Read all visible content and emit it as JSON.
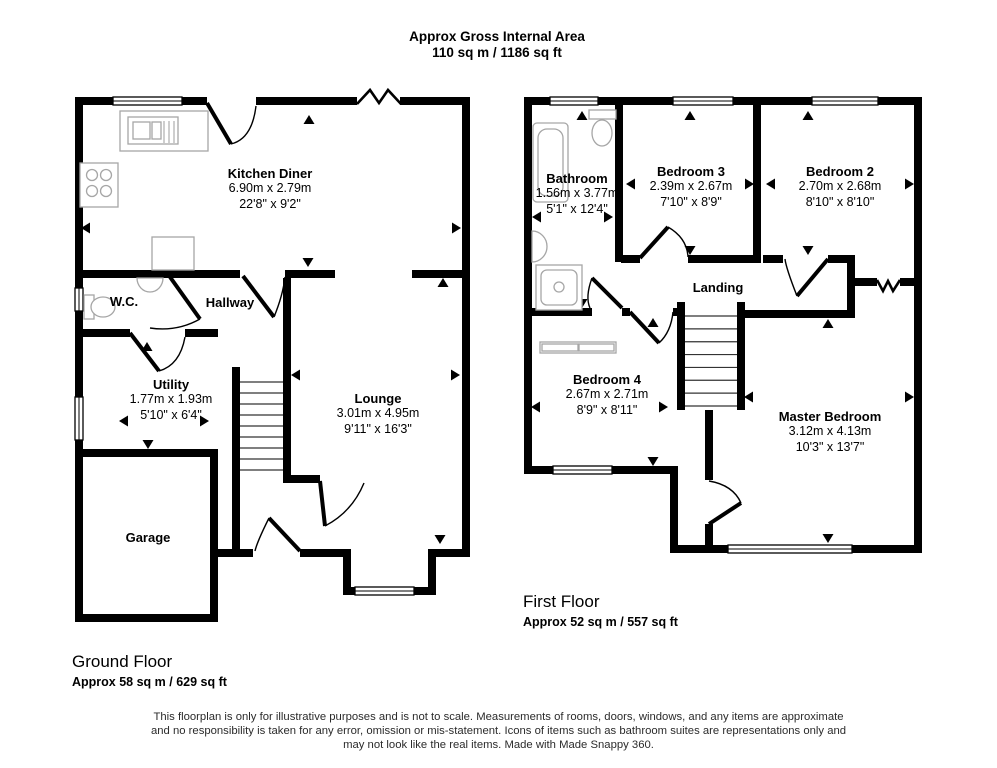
{
  "title": {
    "line1": "Approx Gross Internal Area",
    "line2": "110 sq m / 1186 sq ft"
  },
  "ground_floor": {
    "heading": "Ground Floor",
    "area": "Approx 58 sq m / 629 sq ft",
    "rooms": {
      "kitchen": {
        "name": "Kitchen Diner",
        "metric": "6.90m x 2.79m",
        "imperial": "22'8\" x 9'2\""
      },
      "wc": {
        "name": "W.C."
      },
      "hallway": {
        "name": "Hallway"
      },
      "utility": {
        "name": "Utility",
        "metric": "1.77m x 1.93m",
        "imperial": "5'10\" x 6'4\""
      },
      "lounge": {
        "name": "Lounge",
        "metric": "3.01m x 4.95m",
        "imperial": "9'11\" x 16'3\""
      },
      "garage": {
        "name": "Garage"
      }
    }
  },
  "first_floor": {
    "heading": "First Floor",
    "area": "Approx 52 sq m / 557 sq ft",
    "rooms": {
      "bathroom": {
        "name": "Bathroom",
        "metric": "1.56m x 3.77m",
        "imperial": "5'1\" x 12'4\""
      },
      "bedroom3": {
        "name": "Bedroom 3",
        "metric": "2.39m x 2.67m",
        "imperial": "7'10\" x 8'9\""
      },
      "bedroom2": {
        "name": "Bedroom 2",
        "metric": "2.70m x 2.68m",
        "imperial": "8'10\" x 8'10\""
      },
      "landing": {
        "name": "Landing"
      },
      "bedroom4": {
        "name": "Bedroom 4",
        "metric": "2.67m x 2.71m",
        "imperial": "8'9\" x 8'11\""
      },
      "master": {
        "name": "Master Bedroom",
        "metric": "3.12m x 4.13m",
        "imperial": "10'3\" x 13'7\""
      }
    }
  },
  "disclaimer": {
    "line1": "This floorplan is only for illustrative purposes and is not to scale. Measurements of rooms, doors, windows, and any items are approximate",
    "line2": "and no responsibility is taken for any error, omission or mis-statement. Icons of items such as bathroom suites are representations only and",
    "line3": "may not look like the real items. Made with Made Snappy 360."
  },
  "colors": {
    "wall": "#000000",
    "fixture": "#a6a6a6",
    "text": "#000000",
    "disclaimer_text": "#2b2b2b"
  }
}
